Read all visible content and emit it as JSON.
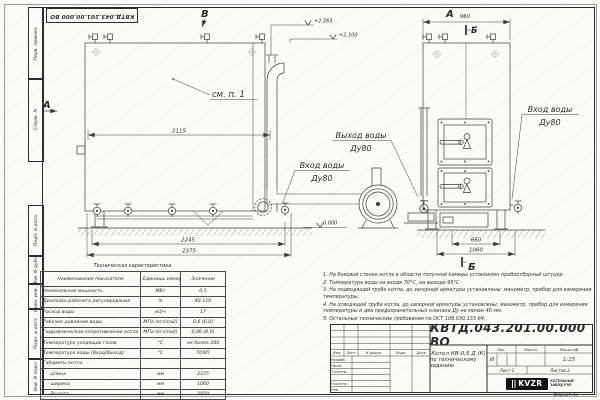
{
  "stamp_top": "КВТД.043.201.00.000 ВО",
  "frame": {
    "left_labels": [
      "Перв. примен.",
      "Справ. N",
      "Подп. и дата",
      "Инв. N дубл.",
      "Взам. инв. N",
      "Подп. и дата",
      "Инв. N подл."
    ],
    "format_note": "Формат  А3"
  },
  "drawing": {
    "view_a": "А",
    "view_b": "В",
    "section_b": "Б",
    "see_note": "см. п. 1",
    "elev_top1": "+2.265",
    "elev_top2": "+2.100",
    "elev_zero": "0.000",
    "dim_2115": "2115",
    "dim_2245": "2245",
    "dim_2375": "2375",
    "dim_960": "960",
    "dim_660": "660",
    "dim_1060": "1060",
    "outlet": {
      "line1": "Выход воды",
      "line2": "Ду80"
    },
    "inlet_side": {
      "line1": "Вход воды",
      "line2": "Ду80"
    },
    "inlet_front": {
      "line1": "Вход воды",
      "line2": "Ду80"
    }
  },
  "spec_table": {
    "title": "Техническая характеристика",
    "headers": [
      "Наименование показателя",
      "Единицы измерения",
      "Значение"
    ],
    "rows": [
      [
        "Номинальная мощность",
        "МВт",
        "0,5"
      ],
      [
        "Диапазон рабочего регулирования",
        "%",
        "40-110"
      ],
      [
        "Расход воды",
        "м3/ч",
        "17"
      ],
      [
        "Рабочее давление воды",
        "МПа (кгс/см2)",
        "0,6 (6,0)"
      ],
      [
        "Гидравлическое сопротивление котла",
        "МПа (кгс/см2)",
        "0,06 (0,6)"
      ],
      [
        "Температура уходящих газов",
        "°С",
        "не более 280"
      ],
      [
        "Температура воды (Вход/Выход)",
        "°С",
        "70/95"
      ],
      [
        "Габариты котла",
        "",
        ""
      ],
      [
        "   - длина",
        "мм",
        "2375"
      ],
      [
        "   - ширина",
        "мм",
        "1060"
      ],
      [
        "   - Высота",
        "мм",
        "2050"
      ]
    ]
  },
  "notes": [
    "1.  На боковой стенке котла в области топочной камеры установлен пробоотборный штуцер",
    "2.  Температура воды на входе 70°С, на выходе 95°С.",
    "3.  На подводящей трубе котла, до запорной арматуры установлены: манометр, прибор для измерения температуры.",
    "4.  На отводящей трубе котла, до запорной арматуры установлены: манометр, прибор для измерения температуры и два предохранительных клапана Ду не менее 40 мм.",
    "5.  Остальные технические требования по ОСТ  108.030.133-84."
  ],
  "title_block": {
    "doc_number": "КВТД.043.201.00.000  ВО",
    "rev_headers": [
      "Изм.",
      "Лист",
      "N докум.",
      "Подп.",
      "Дата"
    ],
    "role_rows": [
      "Разраб.",
      "Пров.",
      "Т.контр.",
      "",
      "Н.контр.",
      "Утв."
    ],
    "title_line1": "Котел  КВ-0,5  Д  (К)",
    "title_line2": "по техническому заданию",
    "lit_header": "Лит.",
    "mass_header": "Масса",
    "scale_header": "Масштаб",
    "lit_value": "И",
    "scale_value": "1:15",
    "sheet_label": "Лист  1",
    "sheets_label": "Листов  2",
    "logo_text": "KVZR",
    "logo_caption_1": "КОТЕЛЬНЫЙ",
    "logo_caption_2": "ЗАВОД РЭП"
  }
}
